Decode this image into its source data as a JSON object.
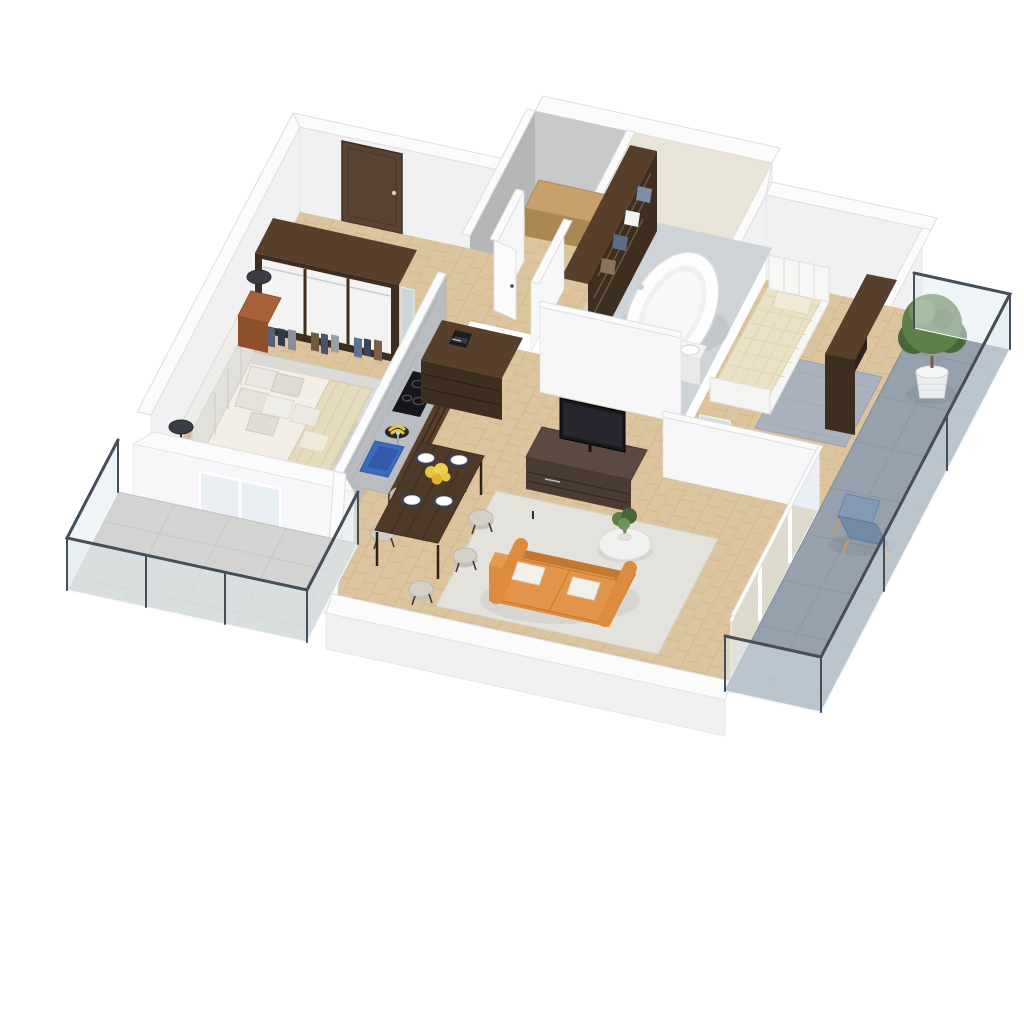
{
  "scene": {
    "kind": "isometric-3d-floor-plan-render",
    "style": "dollhouse-cutaway",
    "background": "#ffffff",
    "floor_material": "herringbone-oak",
    "has_text": false
  },
  "palette": {
    "wall_top": "#fbfbfc",
    "wall_face": "#f1f1f4",
    "wall_face_bright": "#f7f7f9",
    "wall_stroke": "#dedfe3",
    "gray_wall": "#b4b6b8",
    "gray_wall_light": "#c7c9cb",
    "tile_wall": "#e9e4d8",
    "bath_floor": "#ced3d8",
    "floor_wood": "#dcc59e",
    "floor_wood_line": "#c8ac7d",
    "balcony_tile": "#96a1ad",
    "balcony_tile_line": "#84909d",
    "terrace_tile": "#d3d4d1",
    "terrace_tile_line": "#c0c2bf",
    "glass": "#dfe9ee",
    "rail_frame": "#454e59",
    "door_wood": "#5a4233",
    "dark_wood": "#583f2c",
    "darker_wood": "#3e2e20",
    "marble": "#b9bdc1",
    "cooktop_black": "#17171b",
    "sink_blue": "#3c6cc0",
    "banana_yellow": "#e6c63e",
    "bed_linen": "#f3efe6",
    "bed_throw": "#e6dbbc",
    "headboard_gray": "#e2e0db",
    "rug_gray": "#dadad6",
    "rug_blue": "#a9b2bc",
    "bedding_waffle": "#eae1c6",
    "sofa_orange": "#dd8b3e",
    "sofa_orange_dark": "#c4772f",
    "rug_living": "#e3e2dd",
    "table_wood": "#4e3a28",
    "chair_fabric": "#d2d0c8",
    "plant_green": "#5e7f4a",
    "plant_green_dark": "#49663a",
    "pot_white": "#eceff0",
    "lamp_dark": "#3a3e44",
    "lounge_blue": "#8499b3",
    "lounge_wood": "#c09a6a",
    "bench_wood": "#c7a06b",
    "nightstand_wood": "#a8613a"
  },
  "rooms": [
    {
      "name": "entrance-hall",
      "items": [
        "entry-door",
        "partition-walls",
        "interior-door-leaves"
      ]
    },
    {
      "name": "master-bedroom",
      "items": [
        "double-bed",
        "tufted-headboard",
        "pillow-stack",
        "open-wardrobe-with-clothes",
        "mirror-panel",
        "nightstand-left",
        "nightstand-right",
        "mushroom-table-lamps",
        "knit-area-rug"
      ]
    },
    {
      "name": "kitchen",
      "items": [
        "marble-half-wall",
        "counter-with-cabinets",
        "induction-cooktop",
        "blue-sink",
        "fruit-bowl-bananas",
        "drawer-cabinet-tower",
        "coffee-machine"
      ]
    },
    {
      "name": "dining-area",
      "items": [
        "rustic-wood-table",
        "upholstered-chairs",
        "place-settings",
        "yellow-flower-centerpiece"
      ]
    },
    {
      "name": "living-room",
      "items": [
        "orange-two-seat-sofa",
        "white-throw-pillows",
        "round-coffee-table",
        "green-plant",
        "tv-sideboard",
        "flatscreen-tv",
        "area-rug"
      ]
    },
    {
      "name": "bathroom",
      "items": [
        "freestanding-oval-bathtub",
        "washbasin-vanity",
        "toilet",
        "linen-shelf-tower",
        "beige-tiled-walls",
        "stone-floor"
      ]
    },
    {
      "name": "laundry-storage",
      "items": [
        "gray-unfinished-walls",
        "wooden-bench"
      ]
    },
    {
      "name": "second-bedroom",
      "items": [
        "single-bed-white-frame",
        "waffle-duvet",
        "blue-gray-rug",
        "open-wardrobe-with-clothes",
        "vanity-desk",
        "beige-armchair"
      ]
    },
    {
      "name": "balcony-southwest",
      "items": [
        "concrete-tile-floor",
        "glass-railing-dark-frame"
      ]
    },
    {
      "name": "terrace-east",
      "items": [
        "blue-stone-tile-floor",
        "glass-railing-dark-frame",
        "potted-tree",
        "blue-lounge-chair"
      ]
    }
  ]
}
